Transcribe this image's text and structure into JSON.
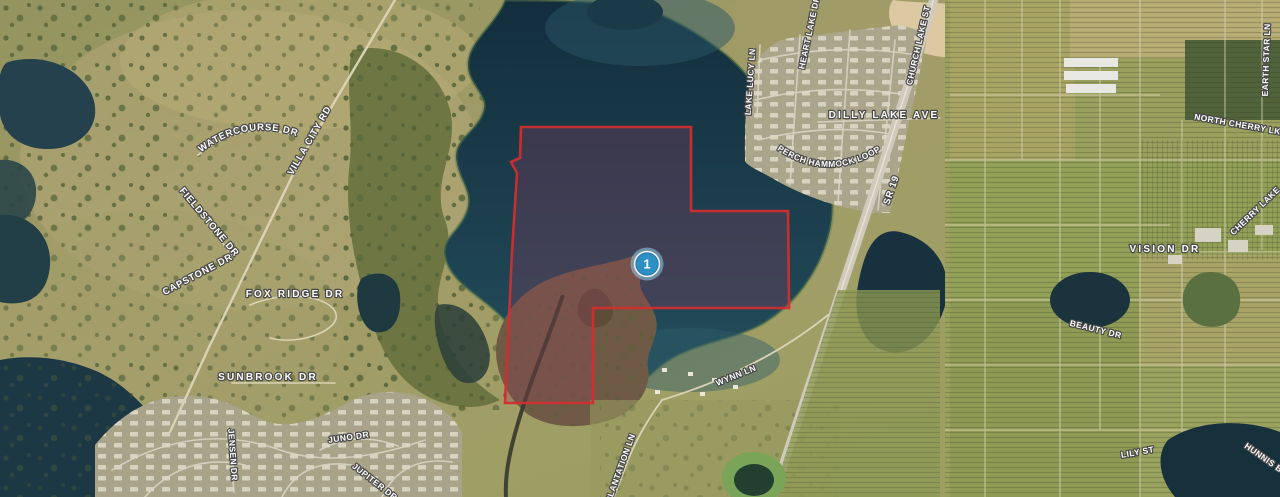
{
  "map": {
    "marker": {
      "label": "1"
    },
    "colors": {
      "parcel_stroke": "#d02f2f",
      "parcel_fill": "rgba(150,60,95,0.30)",
      "marker_fill": "#2e8fc2",
      "marker_ring": "#eef4f7",
      "marker_halo": "rgba(140,195,220,0.6)"
    },
    "road_labels": {
      "watercourse": "WATERCOURSE DR",
      "villa_city": "VILLA CITY RD",
      "fieldstone": "FIELDSTONE DR",
      "capstone": "CAPSTONE DR",
      "fox_ridge": "FOX RIDGE DR",
      "sunbrook": "SUNBROOK DR",
      "jensen": "JENSEN DR",
      "juno": "JUNO DR",
      "jupiter": "JUPITER DR",
      "plantation": "PLANTATION LN",
      "wynn": "WYNN LN",
      "lake_lucy": "LAKE LUCY LN",
      "heart_lake": "HEART LAKE DR",
      "church_lake": "CHURCH LAKE ST",
      "dilly_lake": "DILLY LAKE AVE",
      "perch_hammock": "PERCH HAMMOCK LOOP",
      "sr19": "SR 19",
      "north_cherry": "NORTH CHERRY LK",
      "earth_star": "EARTH STAR LN",
      "vision": "VISION DR",
      "beauty": "BEAUTY DR",
      "cherry_lake": "CHERRY LAKE",
      "lily": "LILY ST",
      "hunnis": "HUNNIS B"
    }
  }
}
